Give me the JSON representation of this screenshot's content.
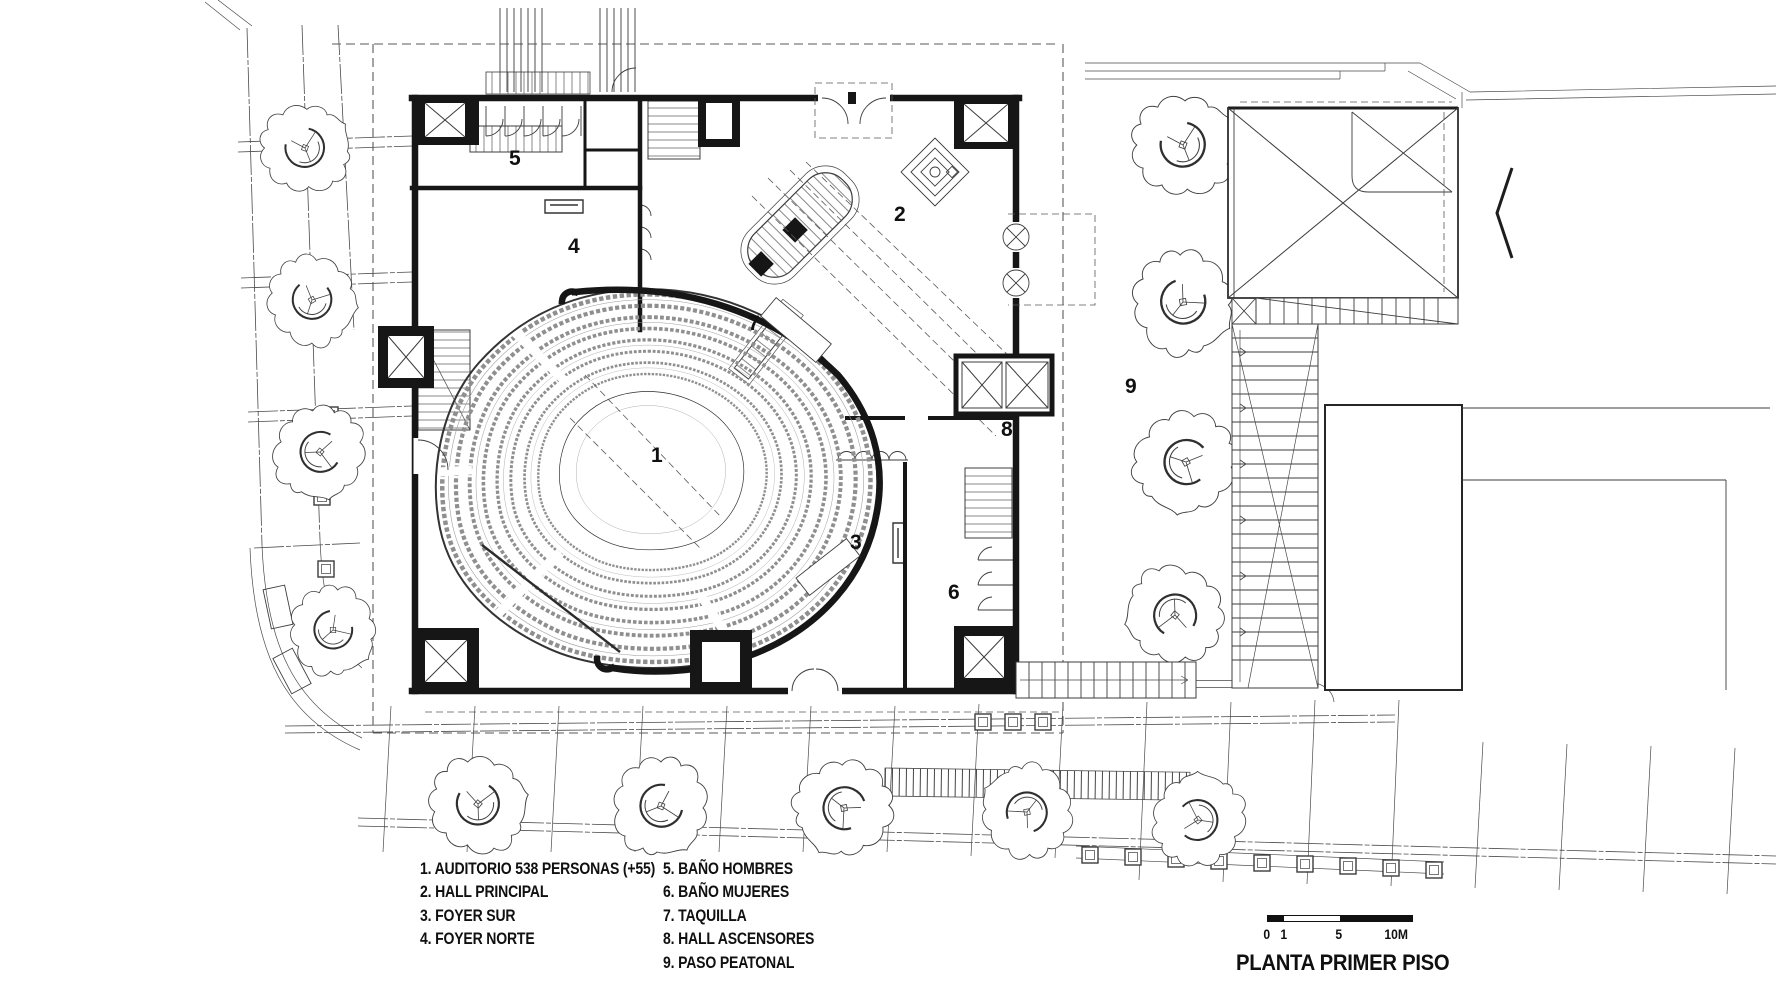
{
  "title": "PLANTA PRIMER PISO",
  "legend": {
    "items": [
      {
        "text": "1. AUDITORIO 538 PERSONAS (+55)"
      },
      {
        "text": "2. HALL PRINCIPAL"
      },
      {
        "text": "3. FOYER SUR"
      },
      {
        "text": "4. FOYER NORTE"
      },
      {
        "text": "5. BAÑO HOMBRES"
      },
      {
        "text": "6. BAÑO MUJERES"
      },
      {
        "text": "7. TAQUILLA"
      },
      {
        "text": "8. HALL ASCENSORES"
      },
      {
        "text": "9. PASO PEATONAL"
      }
    ]
  },
  "plan": {
    "n1": "1",
    "n2": "2",
    "n3": "3",
    "n4": "4",
    "n5": "5",
    "n6": "6",
    "n7": "7",
    "n8": "8",
    "n9": "9"
  },
  "scale_bar": {
    "zero": "0",
    "one": "1",
    "five": "5",
    "ten": "10M"
  },
  "colors": {
    "ink": "#161616",
    "thin_line": "#4a4a4a",
    "seat_gray": "#8f8f8f",
    "paper": "#ffffff"
  }
}
